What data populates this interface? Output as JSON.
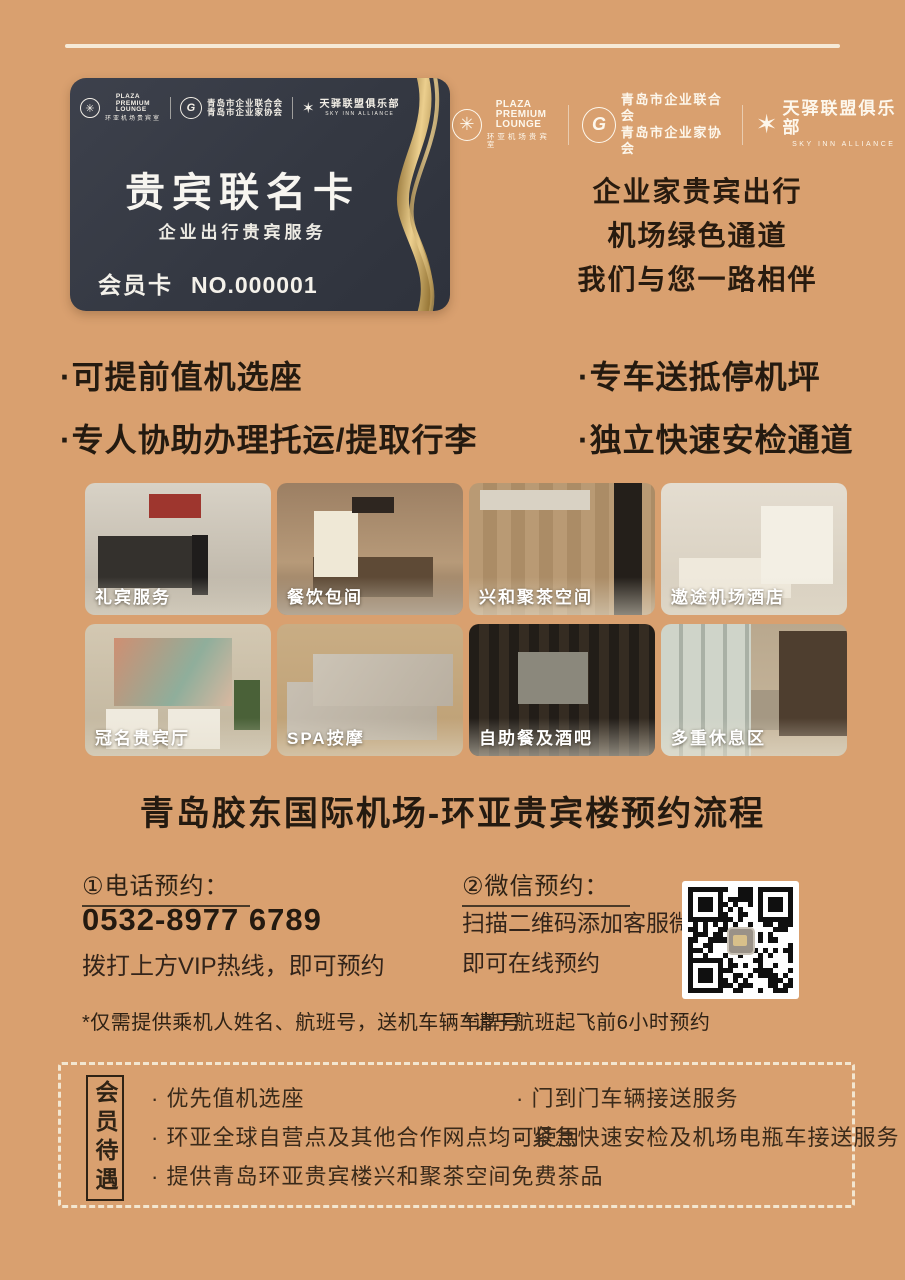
{
  "colors": {
    "background": "#d9a06f",
    "cream": "#f6ead7",
    "dark_text": "#241a10",
    "card_bg": "#363a45",
    "gold": "#caa45c"
  },
  "logos": {
    "plaza": {
      "l1": "PLAZA",
      "l2": "PREMIUM",
      "l3": "LOUNGE",
      "sub": "环亚机场贵宾室"
    },
    "qingdao": {
      "letter": "G",
      "line1": "青岛市企业联合会",
      "line2": "青岛市企业家协会"
    },
    "sky": {
      "title": "天驿联盟俱乐部",
      "sub": "SKY INN ALLIANCE"
    }
  },
  "card": {
    "title": "贵宾联名卡",
    "subtitle": "企业出行贵宾服务",
    "member_label": "会员卡",
    "member_no": "NO.000001"
  },
  "slogan": {
    "line1": "企业家贵宾出行",
    "line2": "机场绿色通道",
    "line3": "我们与您一路相伴"
  },
  "benefits": {
    "left": [
      "·可提前值机选座",
      "·专人协助办理托运/提取行李"
    ],
    "right": [
      "·专车送抵停机坪",
      "·独立快速安检通道"
    ]
  },
  "gallery": {
    "items": [
      {
        "label": "礼宾服务"
      },
      {
        "label": "餐饮包间"
      },
      {
        "label": "兴和聚茶空间"
      },
      {
        "label": "遨途机场酒店"
      },
      {
        "label": "冠名贵宾厅"
      },
      {
        "label": "SPA按摩"
      },
      {
        "label": "自助餐及酒吧"
      },
      {
        "label": "多重休息区"
      }
    ]
  },
  "flow": {
    "title": "青岛胶东国际机场-环亚贵宾楼预约流程"
  },
  "booking": {
    "phone": {
      "heading": "①电话预约：",
      "number": "0532-8977 6789",
      "note": "拨打上方VIP热线，即可预约",
      "footnote": "*仅需提供乘机人姓名、航班号，送机车辆车牌号"
    },
    "wechat": {
      "heading": "②微信预约：",
      "line1": "扫描二维码添加客服微信",
      "line2": "即可在线预约",
      "footnote": "*请于航班起飞前6小时预约"
    }
  },
  "membership": {
    "label": "会员待遇",
    "left_items": [
      "· 优先值机选座",
      "· 环亚全球自营点及其他合作网点均可使用",
      "· 提供青岛环亚贵宾楼兴和聚茶空间免费茶品"
    ],
    "right_items": [
      "· 门到门车辆接送服务",
      "· 紧急快速安检及机场电瓶车接送服务"
    ]
  }
}
